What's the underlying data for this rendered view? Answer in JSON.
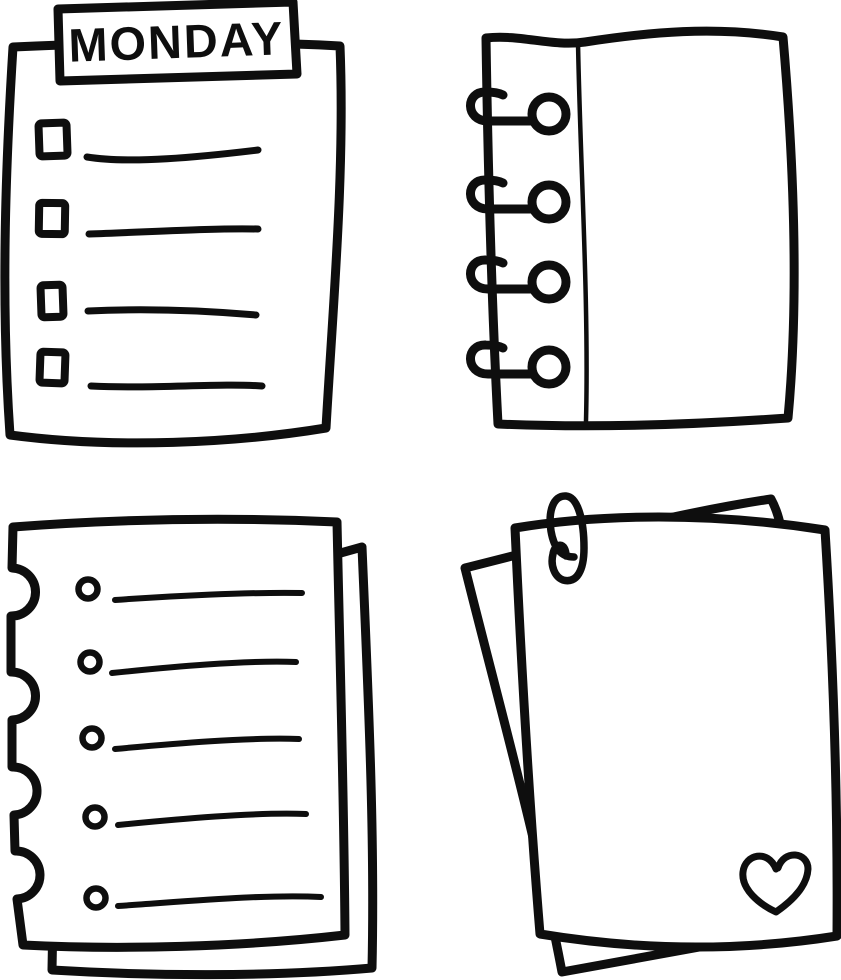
{
  "canvas": {
    "background_color": "#ffffff",
    "ink_color": "#0e0e0e",
    "style": "hand-drawn black-and-white doodle set of paper notes"
  },
  "figures": {
    "monday_checklist": {
      "icon": "checklist-note-icon",
      "title": "MONDAY",
      "checkbox_count": 4,
      "ruled_line_count": 4
    },
    "spiral_notebook": {
      "icon": "spiral-notebook-page-icon",
      "binder_ring_count": 4,
      "has_margin_line": true
    },
    "torn_note": {
      "icon": "torn-notebook-page-icon",
      "hole_count": 5,
      "ruled_line_count": 5,
      "notch_count": 4,
      "sheet_count": 2
    },
    "paper_stack": {
      "icon": "paper-stack-icon",
      "sheet_count": 2,
      "decorations": [
        "paperclip-icon",
        "heart-icon"
      ]
    }
  }
}
